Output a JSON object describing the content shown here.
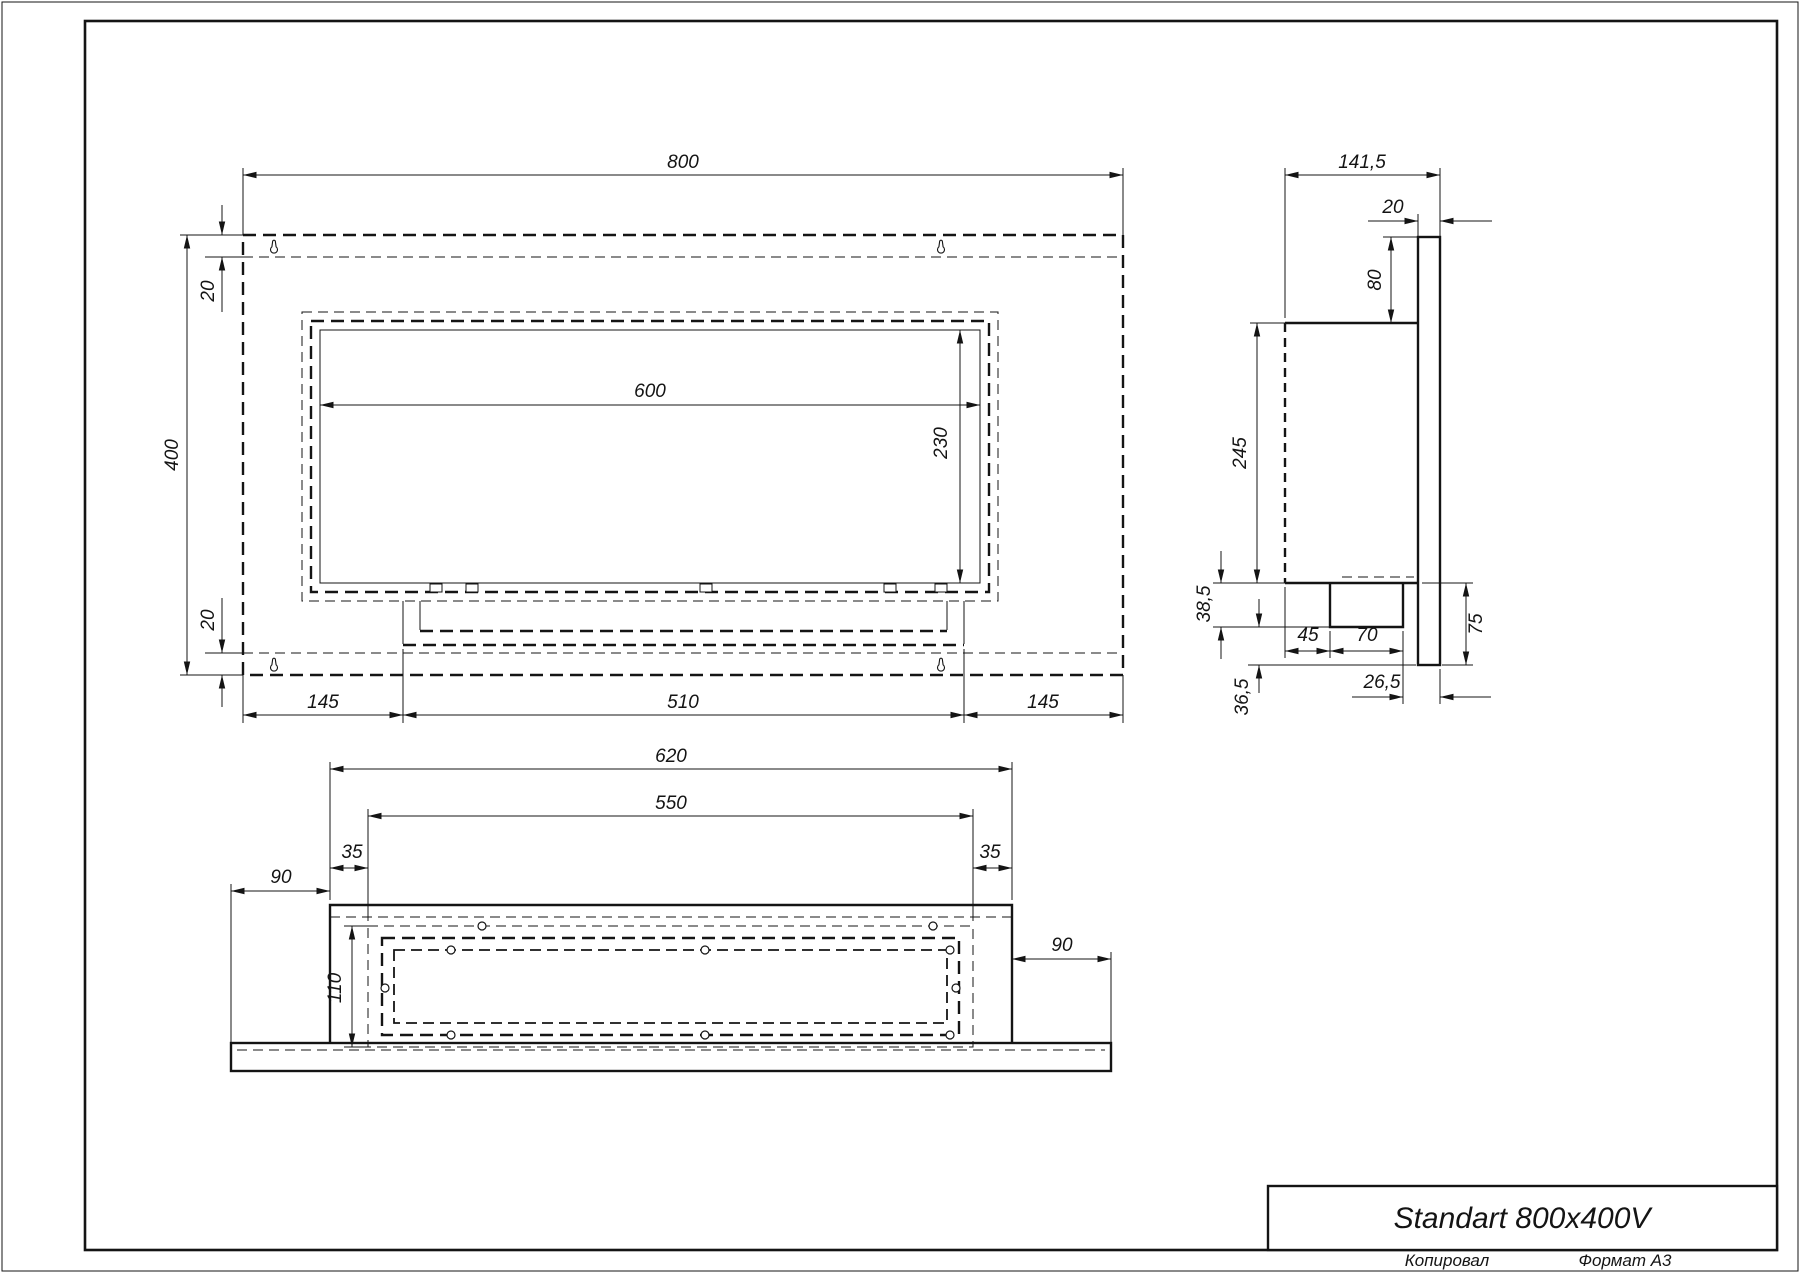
{
  "title_block": {
    "title": "Standart 800x400V"
  },
  "footer": {
    "copied_by": "Копировал",
    "format": "Формат А3"
  },
  "front_view": {
    "width": "800",
    "height": "400",
    "top_offset": "20",
    "bottom_offset": "20",
    "window_width": "600",
    "window_height": "230",
    "left_margin": "145",
    "tray_width": "510",
    "right_margin": "145"
  },
  "side_view": {
    "depth": "141,5",
    "plate_thickness": "20",
    "plate_top_drop": "80",
    "body_height": "245",
    "tray_drop": "38,5",
    "lower_drop": "36,5",
    "front_inset": "45",
    "burner_width": "70",
    "back_gap": "26,5",
    "plate_below_body": "75"
  },
  "bottom_view": {
    "body_width": "620",
    "frame_width": "550",
    "left_inset": "35",
    "right_inset": "35",
    "left_wing": "90",
    "right_wing": "90",
    "frame_depth": "110"
  },
  "colors": {
    "ink": "#141414",
    "paper": "#ffffff"
  }
}
